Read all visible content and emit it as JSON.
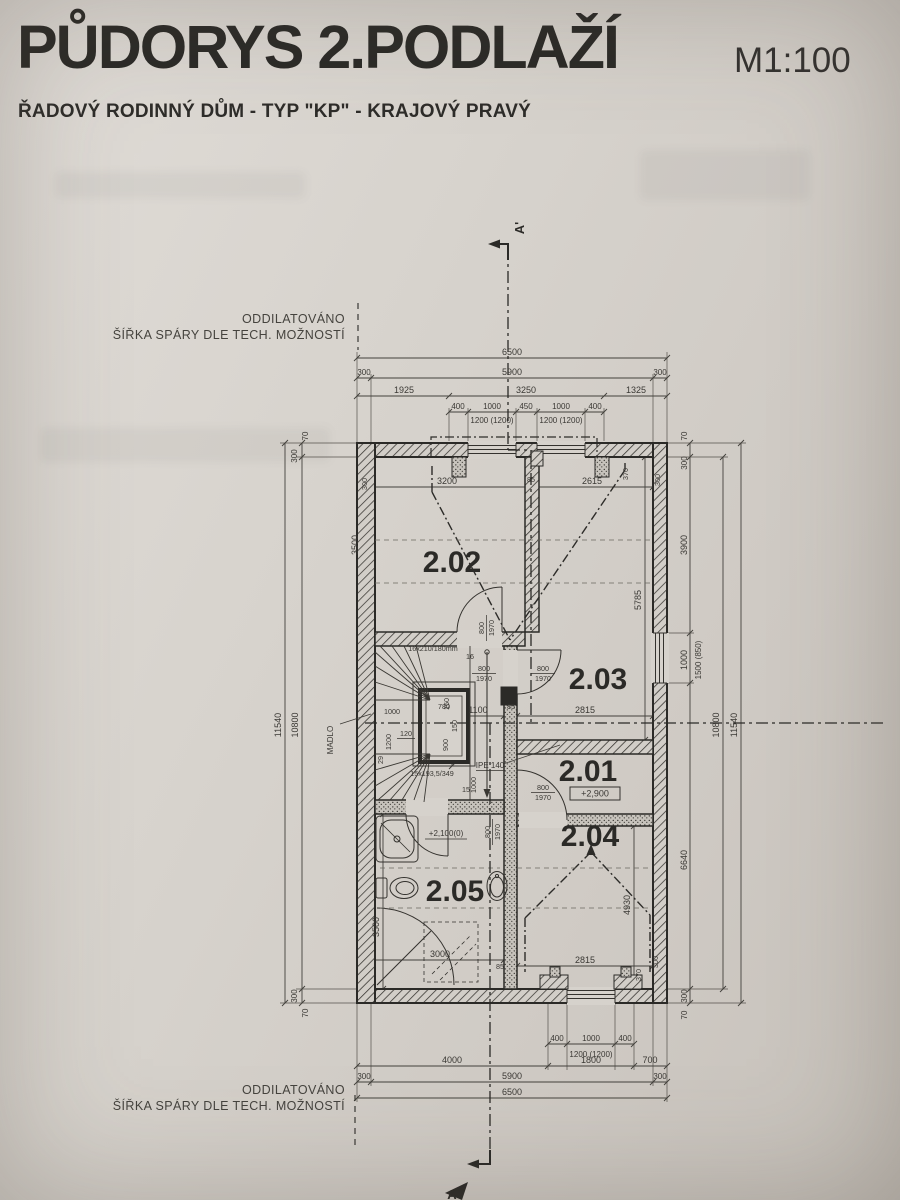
{
  "header": {
    "title": "PŮDORYS 2.PODLAŽÍ",
    "scale": "M1:100",
    "subtitle": "ŘADOVÝ RODINNÝ DŮM - TYP \"KP\" - KRAJOVÝ PRAVÝ"
  },
  "notes": {
    "line1": "ODDILATOVÁNO",
    "line2": "ŠÍŘKA SPÁRY DLE TECH. MOŽNOSTÍ"
  },
  "section": {
    "top": "A'",
    "bottom": "A"
  },
  "rooms": {
    "r201": "2.01",
    "r202": "2.02",
    "r203": "2.03",
    "r204": "2.04",
    "r205": "2.05"
  },
  "levels": {
    "hall": "+2,900",
    "bath": "+2,100(0)"
  },
  "door": {
    "w": "800",
    "h": "1970"
  },
  "stair": {
    "flight_up": "16x210/180mm",
    "flight_down": "15x193,5/349",
    "handrail": "MADLO",
    "beam": "IPE 140",
    "n16": "16",
    "n15": "15",
    "n29": "29",
    "core_w": "780",
    "core_clear": "120",
    "arm": "1000",
    "width": "1200"
  },
  "dims": {
    "d70": "70",
    "d300": "300",
    "d85": "85",
    "d150": "150",
    "d370": "370",
    "top": {
      "total": "6500",
      "mid": "5900",
      "a": "1925",
      "b": "3250",
      "c": "1325",
      "g400": "400",
      "g1000": "1000",
      "g450": "450",
      "win": "1200 (1200)"
    },
    "bottom": {
      "g400": "400",
      "g1000": "1000",
      "win": "1200 (1200)",
      "a": "4000",
      "b": "1800",
      "c": "700",
      "mid": "5900",
      "total": "6500"
    },
    "left": {
      "total": "11540",
      "inner": "10800",
      "r202": "3500",
      "bath": "3500"
    },
    "right": {
      "a": "3900",
      "win": "1000",
      "parapet": "1500 (850)",
      "b": "6640",
      "inner": "10800",
      "total": "11540",
      "r203": "5785",
      "r204": "4930"
    },
    "inner_top": {
      "a": "3200",
      "b": "2615"
    },
    "hall": {
      "a": "1100",
      "b": "2815",
      "c": "900",
      "d": "1000",
      "n15": "15"
    },
    "bath": {
      "w": "3000",
      "b": "2815"
    }
  }
}
